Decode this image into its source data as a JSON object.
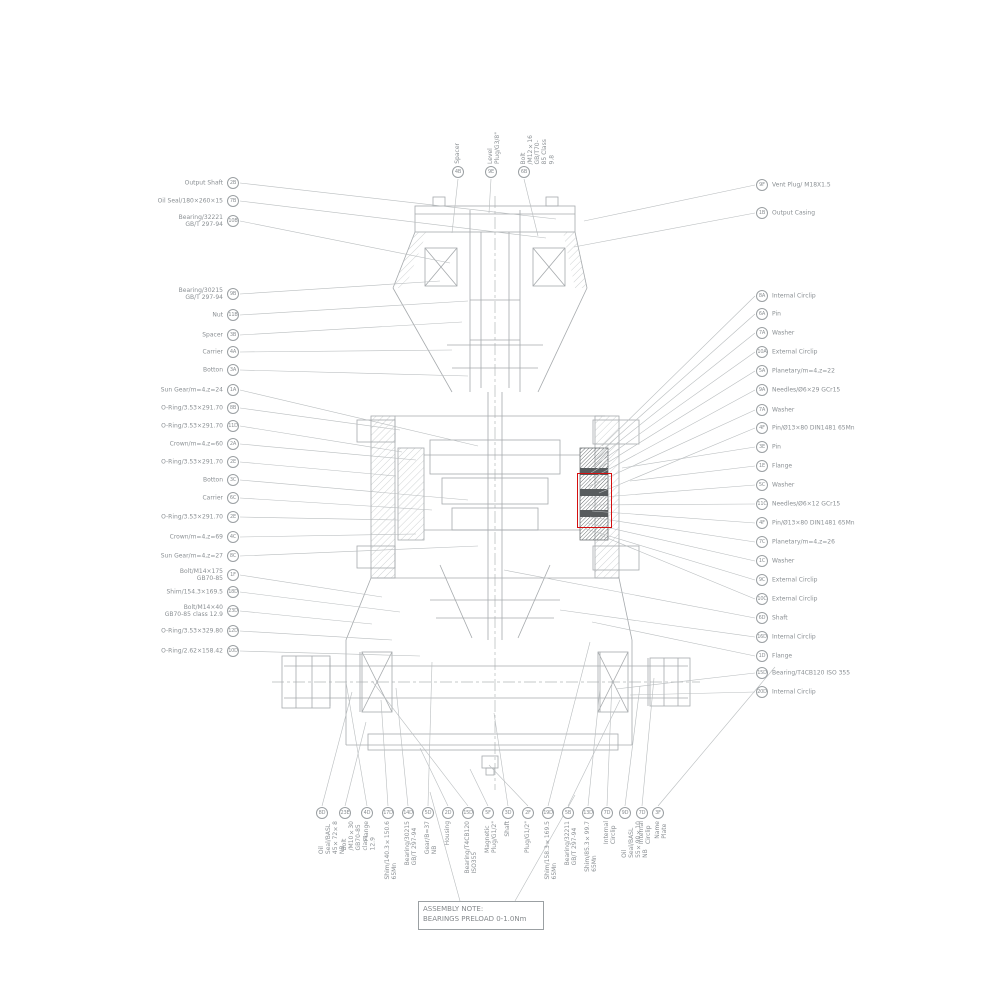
{
  "note": {
    "heading": "ASSEMBLY NOTE:",
    "body": "BEARINGS PRELOAD 0-1.0Nm"
  },
  "colors": {
    "linework": "#a6aaad",
    "label_text": "#8b9094",
    "highlight": "#d40f0f"
  },
  "callouts": {
    "top_left": [
      {
        "label": "Output Shaft",
        "ref": "2B"
      },
      {
        "label": "Oil Seal/180×260×15",
        "ref": "7B"
      },
      {
        "label": "Bearing/32221\nGB/T 297-94",
        "ref": "10B"
      }
    ],
    "top": [
      {
        "label": "Spacer",
        "ref": "4B"
      },
      {
        "label": "Level Plug/G3/8\"",
        "ref": "9E"
      },
      {
        "label": "Bolt /M12×16 GB/T70-85 Class 9.8",
        "ref": "6B"
      }
    ],
    "top_right": [
      {
        "label": "Vent Plug/ M18X1.5",
        "ref": "9F"
      },
      {
        "label": "Output Casing",
        "ref": "1B"
      }
    ],
    "left": [
      {
        "label": "Bearing/30215\nGB/T 297-94",
        "ref": "9B"
      },
      {
        "label": "Nut",
        "ref": "11B"
      },
      {
        "label": "Spacer",
        "ref": "3B"
      },
      {
        "label": "Carrier",
        "ref": "4A"
      },
      {
        "label": "Botton",
        "ref": "3A"
      },
      {
        "label": "Sun Gear/m=4,z=24",
        "ref": "1A"
      },
      {
        "label": "O-Ring/3.53×291.70",
        "ref": "8B"
      },
      {
        "label": "O-Ring/3.53×291.70",
        "ref": "11D"
      },
      {
        "label": "Crown/m=4,z=60",
        "ref": "2A"
      },
      {
        "label": "O-Ring/3.53×291.70",
        "ref": "2E"
      },
      {
        "label": "Botton",
        "ref": "3C"
      },
      {
        "label": "Carrier",
        "ref": "6C"
      },
      {
        "label": "O-Ring/3.53×291.70",
        "ref": "2E"
      },
      {
        "label": "Crown/m=4,z=69",
        "ref": "4C"
      },
      {
        "label": "Sun Gear/m=4,z=27",
        "ref": "8C"
      },
      {
        "label": "Bolt/M14×175\nGB70-85",
        "ref": "1F"
      },
      {
        "label": "Shim/154.3×169.5",
        "ref": "18D"
      },
      {
        "label": "Bolt/M14×40\nGB70-85 class 12.9",
        "ref": "23D"
      },
      {
        "label": "O-Ring/3.53×329.80",
        "ref": "12D"
      },
      {
        "label": "O-Ring/2.62×158.42",
        "ref": "10D"
      }
    ],
    "right": [
      {
        "label": "Internal Circlip",
        "ref": "8A"
      },
      {
        "label": "Pin",
        "ref": "6A"
      },
      {
        "label": "Washer",
        "ref": "7A"
      },
      {
        "label": "External Circlip",
        "ref": "10A"
      },
      {
        "label": "Planetary/m=4,z=22",
        "ref": "5A"
      },
      {
        "label": "Needles/Ø6×29  GCr15",
        "ref": "9A"
      },
      {
        "label": "Washer",
        "ref": "7A"
      },
      {
        "label": "Pin/Ø13×80 DIN1481 65Mn",
        "ref": "4F"
      },
      {
        "label": "Pin",
        "ref": "3E"
      },
      {
        "label": "Flange",
        "ref": "1E"
      },
      {
        "label": "Washer",
        "ref": "5C"
      },
      {
        "label": "Needles/Ø6×12 GCr15",
        "ref": "11C"
      },
      {
        "label": "Pin/Ø13×80 DIN1481 65Mn",
        "ref": "4F"
      },
      {
        "label": "Planetary/m=4,z=26",
        "ref": "7C"
      },
      {
        "label": "Washer",
        "ref": "1C"
      },
      {
        "label": "External Circlip",
        "ref": "9C"
      },
      {
        "label": "External Circlip",
        "ref": "10C"
      },
      {
        "label": "Shaft",
        "ref": "6D"
      },
      {
        "label": "Internal Circlip",
        "ref": "16D"
      },
      {
        "label": "Flange",
        "ref": "1D"
      },
      {
        "label": "Bearing/T4CB120 ISO 355",
        "ref": "15D"
      },
      {
        "label": "Internal Circlip",
        "ref": "20D"
      }
    ],
    "bottom": [
      {
        "label": "Oil Seal/BASL  45×72×8 NB",
        "ref": "8D"
      },
      {
        "label": "Bolt /M10×30 GB70-85 class 12.9",
        "ref": "23E"
      },
      {
        "label": "Flange",
        "ref": "4D"
      },
      {
        "label": "Shim/140.3×150.6 65Mn",
        "ref": "17D"
      },
      {
        "label": "Bearing/30215 GB/T 297-94",
        "ref": "14D"
      },
      {
        "label": "Gear/B=37 NB",
        "ref": "5D"
      },
      {
        "label": "Housing",
        "ref": "2D"
      },
      {
        "label": "Bearing/T4CB120 ISO355",
        "ref": "15D"
      },
      {
        "label": "Magnetic Plug/G1/2\"",
        "ref": "5F"
      },
      {
        "label": "Shaft",
        "ref": "3D"
      },
      {
        "label": "Plug/G1/2\"",
        "ref": "2F"
      },
      {
        "label": "Shim/158.3×169.5 65Mn",
        "ref": "19D"
      },
      {
        "label": "Bearing/32211 GB/T 297-94",
        "ref": "5B"
      },
      {
        "label": "Shim/85.3×99.7 65Mn",
        "ref": "13D"
      },
      {
        "label": "Internal Circlip",
        "ref": "7D"
      },
      {
        "label": "Oil Seal/BASL  55×90×10 NB",
        "ref": "9D"
      },
      {
        "label": "Internal Circlip",
        "ref": "7D"
      },
      {
        "label": "Name Plate",
        "ref": "3F"
      }
    ]
  }
}
